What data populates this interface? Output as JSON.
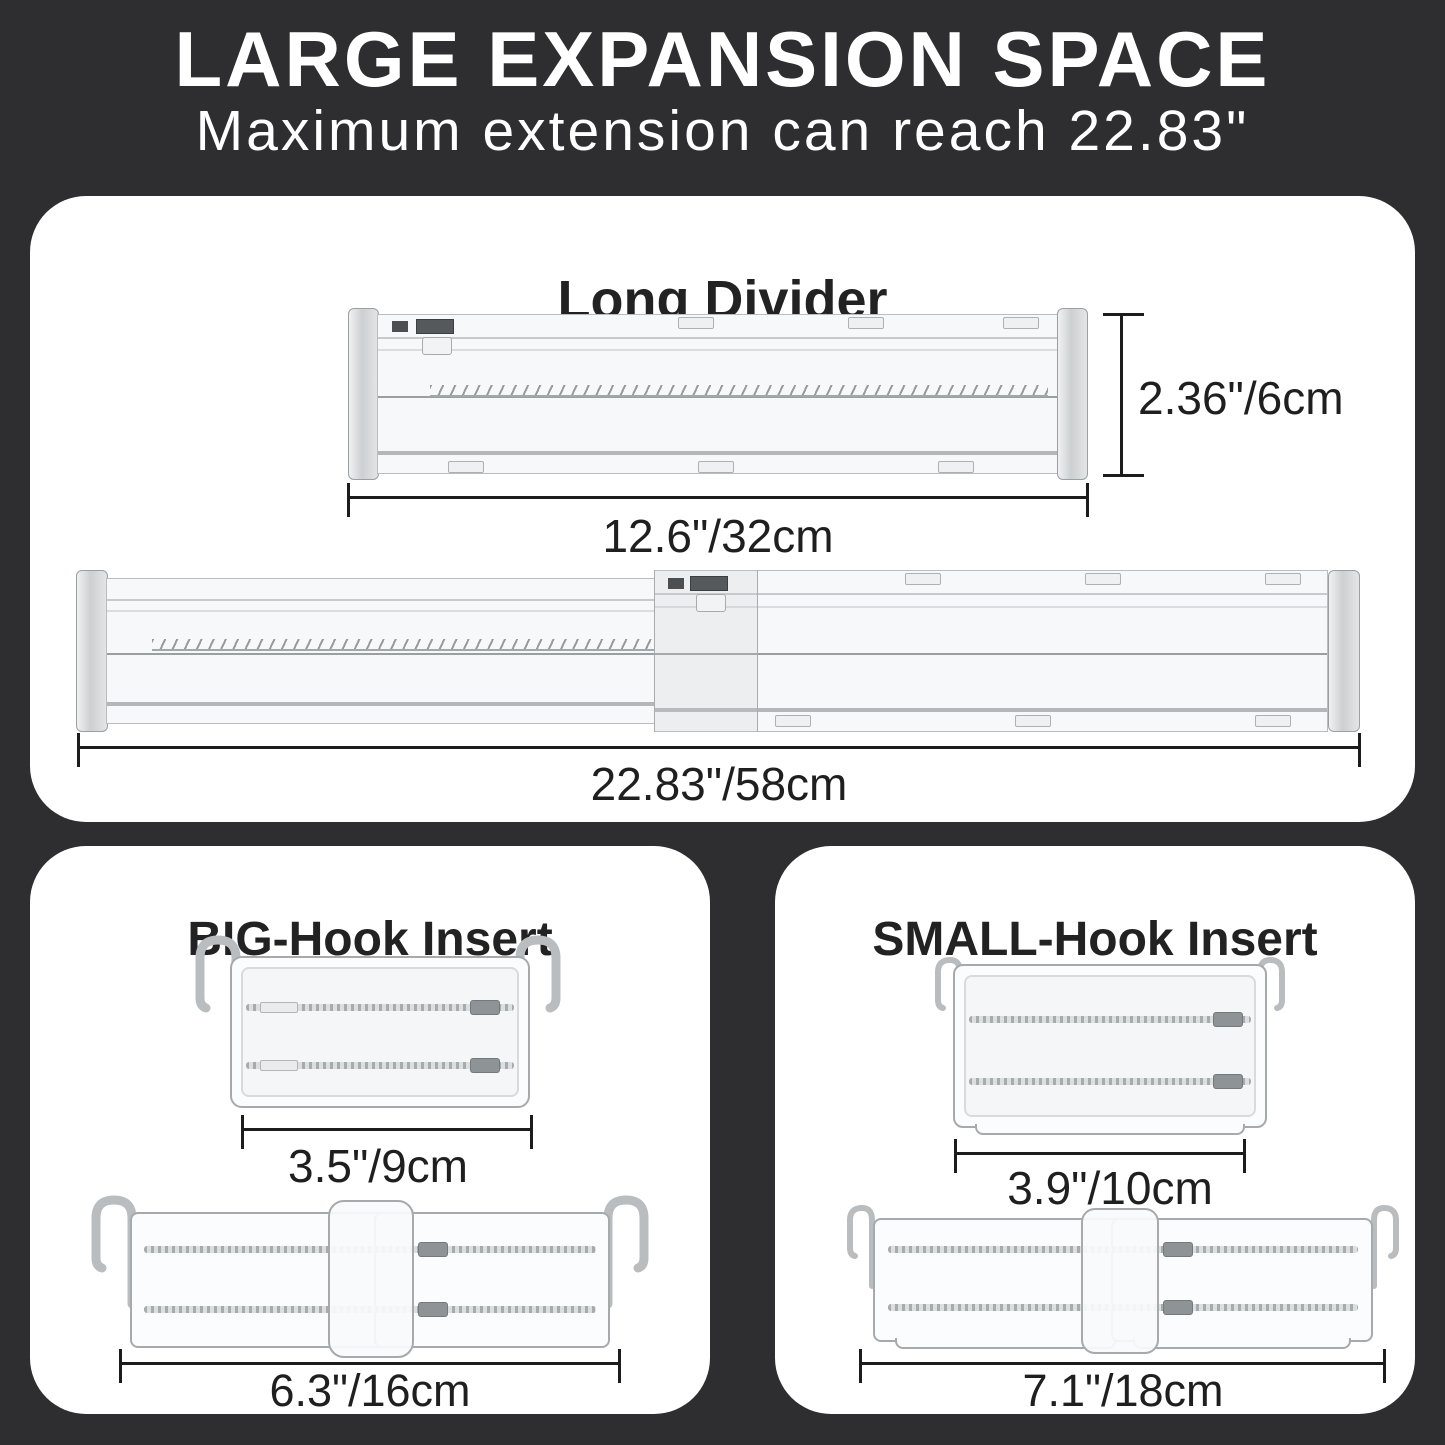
{
  "colors": {
    "background": "#2e2e30",
    "panel": "#ffffff",
    "heading_text": "#222222",
    "dimension_text": "#1f1f1f",
    "title_text": "#ffffff"
  },
  "header": {
    "title": "LARGE EXPANSION SPACE",
    "subtitle": "Maximum extension can reach 22.83\""
  },
  "long_divider_panel": {
    "title": "Long Divider",
    "height_label": "2.36\"/6cm",
    "retracted_length_label": "12.6\"/32cm",
    "extended_length_label": "22.83\"/58cm"
  },
  "big_hook_panel": {
    "title": "BIG-Hook Insert",
    "retracted_length_label": "3.5\"/9cm",
    "extended_length_label": "6.3\"/16cm"
  },
  "small_hook_panel": {
    "title": "SMALL-Hook Insert",
    "retracted_length_label": "3.9\"/10cm",
    "extended_length_label": "7.1\"/18cm"
  }
}
